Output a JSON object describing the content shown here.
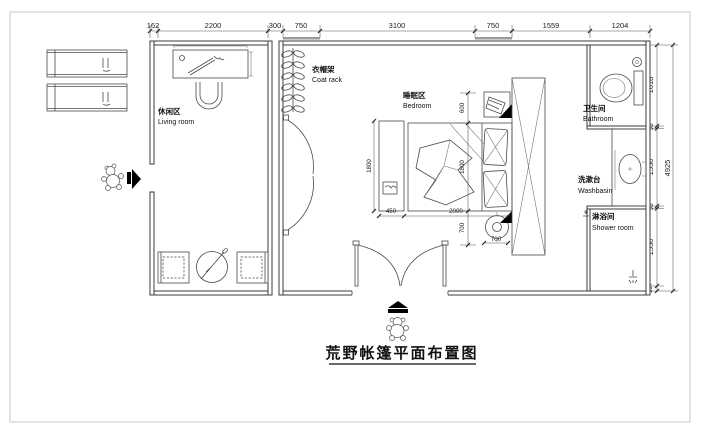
{
  "title": "荒野帐篷平面布置图",
  "rooms": {
    "living": {
      "zh": "休闲区",
      "en": "Living room"
    },
    "coat_rack": {
      "zh": "衣帽架",
      "en": "Coat rack"
    },
    "bedroom": {
      "zh": "睡眠区",
      "en": "Bedroom"
    },
    "bathroom": {
      "zh": "卫生间",
      "en": "Bathroom"
    },
    "washbasin": {
      "zh": "洗漱台",
      "en": "Washbasin"
    },
    "shower": {
      "zh": "淋浴间",
      "en": "Shower room"
    }
  },
  "dims": {
    "top": [
      "162",
      "2200",
      "300",
      "750",
      "3100",
      "750",
      "1559",
      "1204"
    ],
    "right": [
      "1618",
      "50",
      "1550",
      "50",
      "1550",
      "107"
    ],
    "right_total": "4925",
    "bed_length": "2000",
    "bench_width": "450",
    "side_col_width": "700",
    "bed_chain": [
      "600",
      "1800",
      "700"
    ],
    "bench_depth": "1800"
  },
  "colors": {
    "line": "#3b3b3b",
    "frame": "#c9c9c9",
    "background": "#ffffff"
  }
}
